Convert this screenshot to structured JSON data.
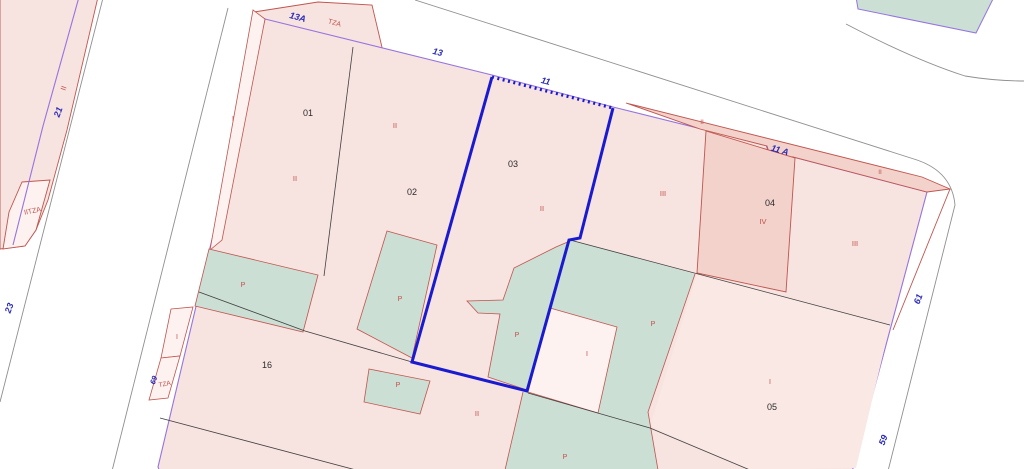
{
  "title": "Cadastral parcel map viewer canvas",
  "labels": {
    "streets": {
      "s13a": "13A",
      "s13": "13",
      "s11": "11",
      "s11a": "11 A",
      "s21": "21",
      "s23": "23",
      "s69": "69",
      "s61": "61",
      "s59": "59"
    },
    "parcels": {
      "p01": "01",
      "p02": "02",
      "p03": "03",
      "p04": "04",
      "p05": "05",
      "p16": "16"
    },
    "constructions": {
      "tza_top": "TZA",
      "left_ii": "II",
      "iitza": "IITZA",
      "strip_i": "I",
      "mid_i": "I",
      "tza_mid": "TZA",
      "c01": "II",
      "c02": "II",
      "c03": "II",
      "c_east": "III",
      "band_l": "II",
      "band_r": "II",
      "c04": "IV",
      "c_r": "III",
      "white_i": "I",
      "c05_i": "I",
      "c16_ii": "II",
      "pat1": "P",
      "pat2": "P",
      "pat3": "P",
      "pat4": "P",
      "pat5": "P",
      "pat6": "P"
    }
  },
  "colors": {
    "bg": "#ffffff",
    "selection_blue": "#1a1ad0",
    "parcel_violet": "#9673e0",
    "building_red": "#c0544e",
    "street_gray": "#8f8f8f",
    "divider_black": "#3f3f3f",
    "pink": "#f7e3df",
    "pink_dark": "#f2d2cb",
    "pink_light": "#fdf2f0",
    "pink_05": "#f9e8e4",
    "green": "#cbdfd4",
    "label_blue": "#2a2ab8",
    "label_red": "#c2504a",
    "label_black": "#2b2b2b"
  }
}
